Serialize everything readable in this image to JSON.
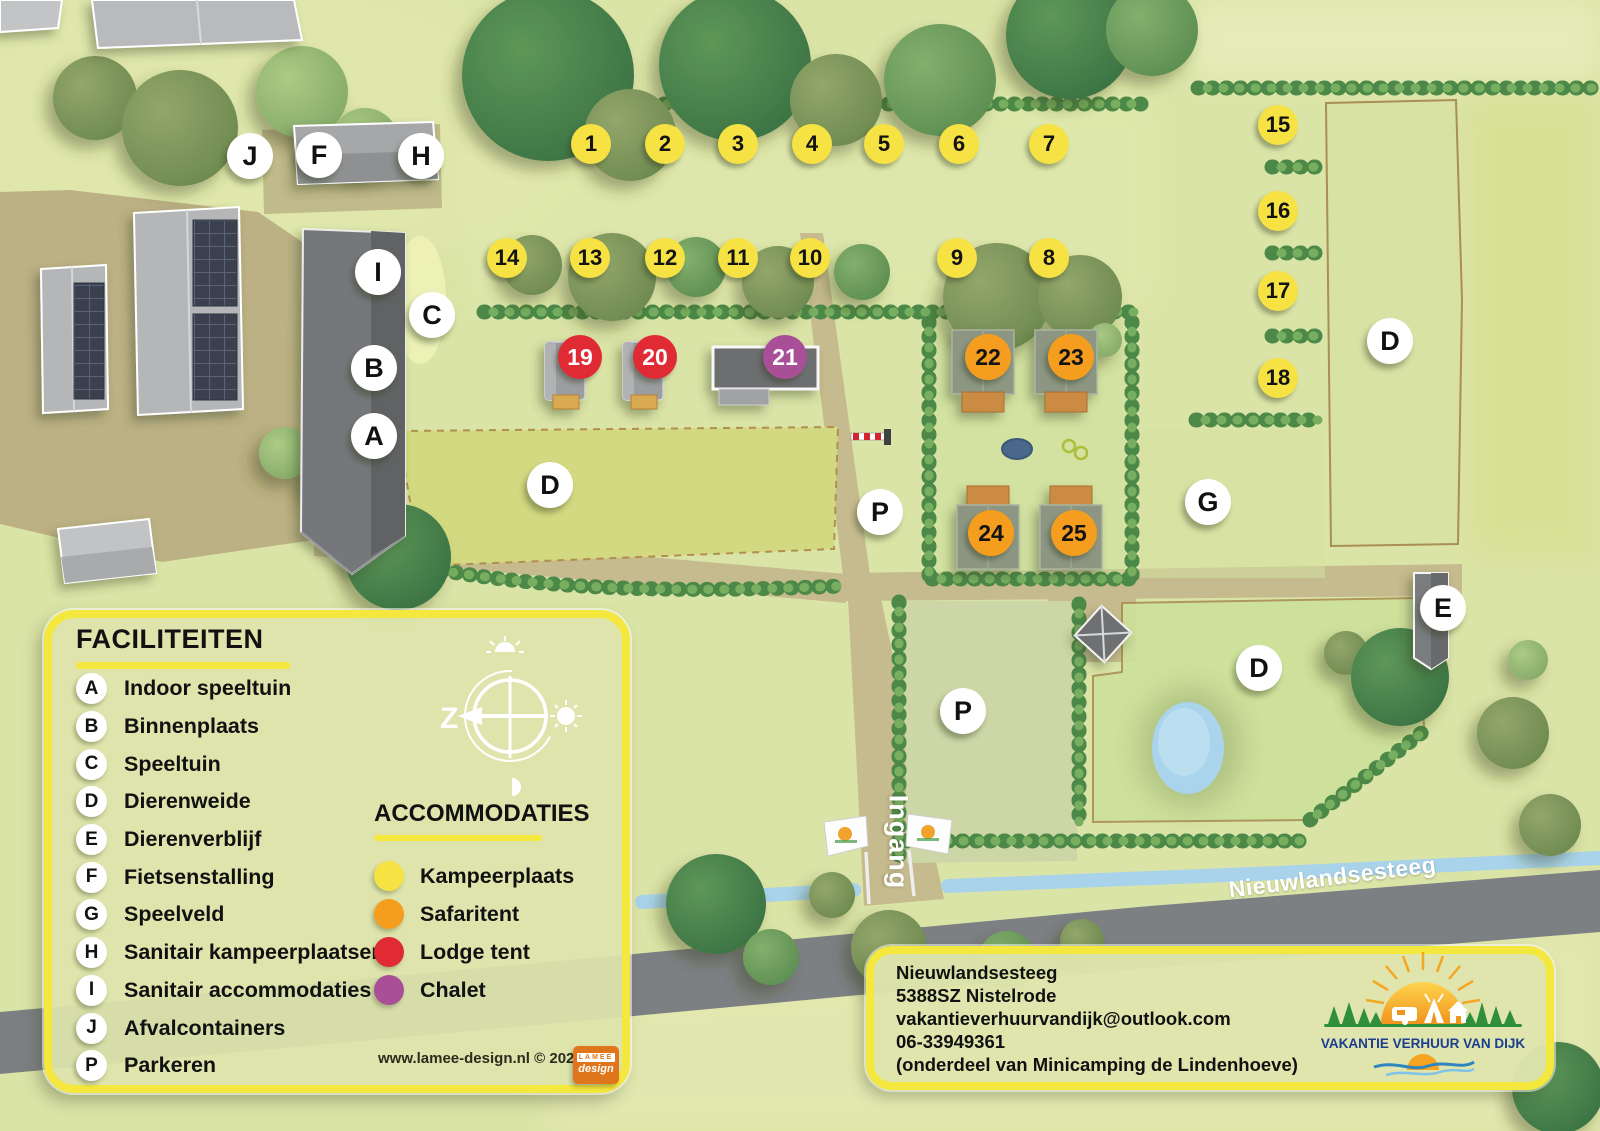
{
  "legend": {
    "facilities_title": "FACILITEITEN",
    "facilities": [
      {
        "key": "A",
        "label": "Indoor speeltuin"
      },
      {
        "key": "B",
        "label": "Binnenplaats"
      },
      {
        "key": "C",
        "label": "Speeltuin"
      },
      {
        "key": "D",
        "label": "Dierenweide"
      },
      {
        "key": "E",
        "label": "Dierenverblijf"
      },
      {
        "key": "F",
        "label": "Fietsenstalling"
      },
      {
        "key": "G",
        "label": "Speelveld"
      },
      {
        "key": "H",
        "label": "Sanitair kampeerplaatsen"
      },
      {
        "key": "I",
        "label": "Sanitair accommodaties"
      },
      {
        "key": "J",
        "label": "Afvalcontainers"
      },
      {
        "key": "P",
        "label": "Parkeren"
      }
    ],
    "accommodations_title": "ACCOMMODATIES",
    "accommodations": [
      {
        "label": "Kampeerplaats",
        "color": "#f6e243"
      },
      {
        "label": "Safaritent",
        "color": "#f49d1e"
      },
      {
        "label": "Lodge tent",
        "color": "#e02b35"
      },
      {
        "label": "Chalet",
        "color": "#a84f97"
      }
    ],
    "credit": "www.lamee-design.nl © 2025",
    "designer": {
      "name": "LAMEE",
      "sub": "design"
    }
  },
  "compass": {
    "letter": "Z"
  },
  "map": {
    "road_name": "Nieuwlandsesteeg",
    "entrance_label": "Ingang",
    "camp_spots": [
      "1",
      "2",
      "3",
      "4",
      "5",
      "6",
      "7",
      "8",
      "9",
      "10",
      "11",
      "12",
      "13",
      "14",
      "15",
      "16",
      "17",
      "18"
    ],
    "lodge_spots": [
      "19",
      "20"
    ],
    "chalet_spots": [
      "21"
    ],
    "safari_spots": [
      "22",
      "23",
      "24",
      "25"
    ],
    "badges": [
      "J",
      "F",
      "H",
      "I",
      "C",
      "B",
      "A",
      "D",
      "P",
      "G",
      "D",
      "E",
      "D",
      "P"
    ]
  },
  "info_box": {
    "address_line1": "Nieuwlandsesteeg",
    "address_line2": "5388SZ Nistelrode",
    "email": "vakantieverhuurvandijk@outlook.com",
    "phone": "06-33949361",
    "note": "(onderdeel van Minicamping de Lindenhoeve)"
  },
  "brand": {
    "name": "VAKANTIE VERHUUR VAN DIJK"
  }
}
